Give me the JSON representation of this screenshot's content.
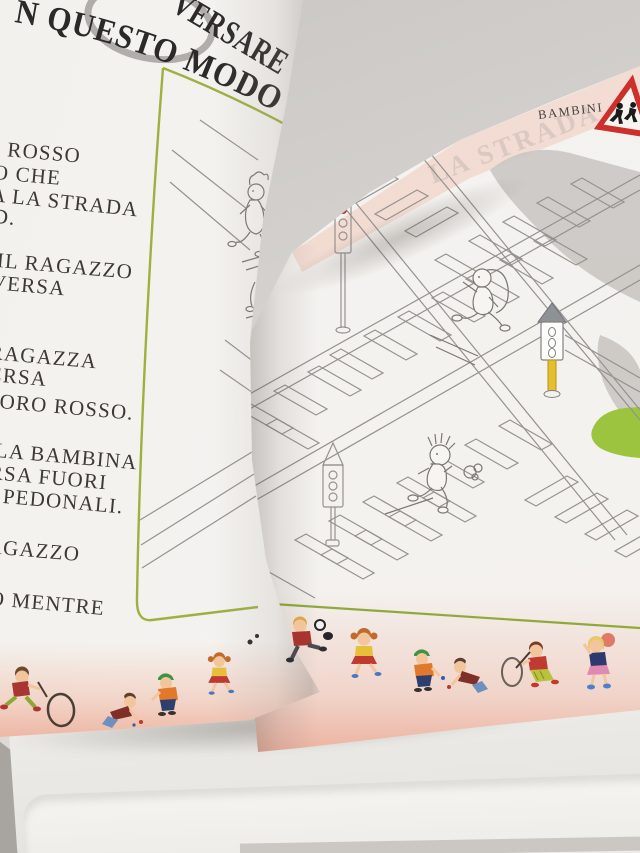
{
  "scene": {
    "description": "Photo of an open Italian children's road-safety activity book lying on a white table, left page mid-turn"
  },
  "left_page": {
    "title": {
      "line1": "VERSARE",
      "line2": "N QUESTO MODO"
    },
    "body_lines": [
      "I ROSSO",
      "O CHE",
      "A LA STRADA",
      "D.",
      "IL RAGAZZO",
      "VERSA",
      "RAGAZZA",
      "ERSA",
      "FORO ROSSO.",
      "LA BAMBINA",
      "RSA FUORI",
      "PEDONALI.",
      "AGAZZO",
      "O MENTRE"
    ],
    "border_figures": [
      "boy-running-with-stick",
      "rolling-hoop",
      "boy-crawling-playing-marbles",
      "boy-green-cap-playing-marbles",
      "girl-running"
    ]
  },
  "right_page": {
    "header_label": "BAMBINI",
    "ghost_text": "LA STRADA",
    "road_sign": "children-crossing-warning-triangle",
    "illustration_elements": [
      "traffic-light-outline-red-lamp",
      "traffic-light-grey-cap-yellow-pole",
      "traffic-light-outline",
      "girl-running-outline",
      "boy-running-outline",
      "girl-outline-near-spine",
      "zebra-crossings",
      "grass-patch",
      "grey-shadow-shapes"
    ],
    "border_figures": [
      "boy-kicking-ball",
      "girl-running",
      "boy-green-cap-playing-marbles",
      "boy-crawling-playing-marbles",
      "boy-with-stick-and-hoop",
      "girl-with-ball"
    ]
  },
  "colors": {
    "frame_green": "#9db13f",
    "sign_red": "#cd2f2a",
    "grass_green": "#9cc43e",
    "pole_yellow": "#e5bf2e",
    "page_edge_pink": "#eea08c",
    "line_grey": "#95928f",
    "text_dark": "#3c3936"
  }
}
